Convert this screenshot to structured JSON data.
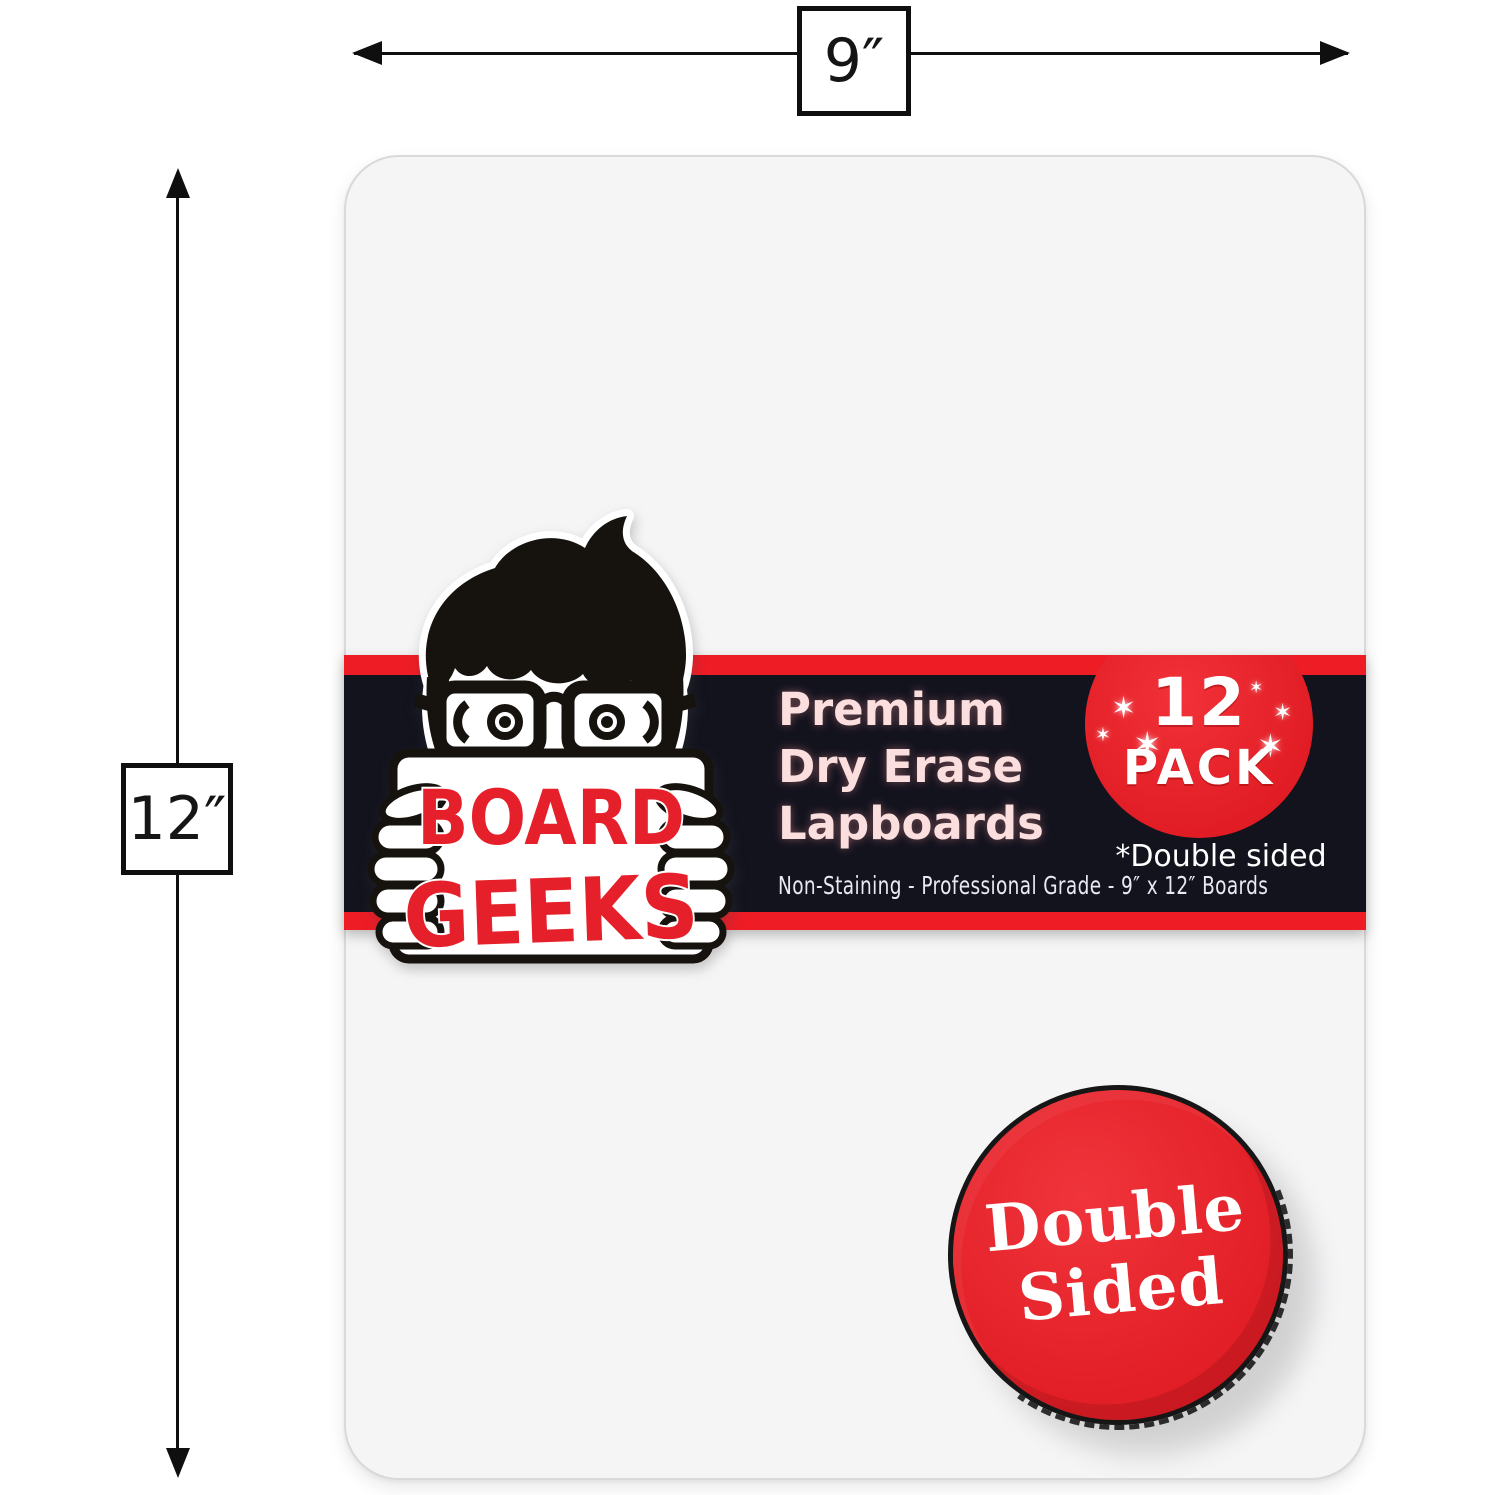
{
  "dimensions": {
    "width_label": "9″",
    "height_label": "12″"
  },
  "brand": {
    "line1": "BOARD",
    "line2": "GEEKS"
  },
  "banner": {
    "title_lines": [
      "Premium",
      "Dry Erase",
      "Lapboards"
    ],
    "subtitle": "Non-Staining - Professional Grade - 9″ x 12″ Boards",
    "pack_badge": {
      "count": "12",
      "label": "PACK",
      "sparkle_glyph": "✶"
    },
    "note": "*Double sided"
  },
  "coin_badge": {
    "line1": "Double",
    "line2": "Sided"
  },
  "colors": {
    "accent_red": "#e8202a",
    "banner_black": "#13131e",
    "board_fill": "#f5f5f6",
    "title_pink": "#fbdfdf",
    "text_white": "#ffffff",
    "ink_black": "#111111",
    "brand_red": "#e6202a"
  }
}
